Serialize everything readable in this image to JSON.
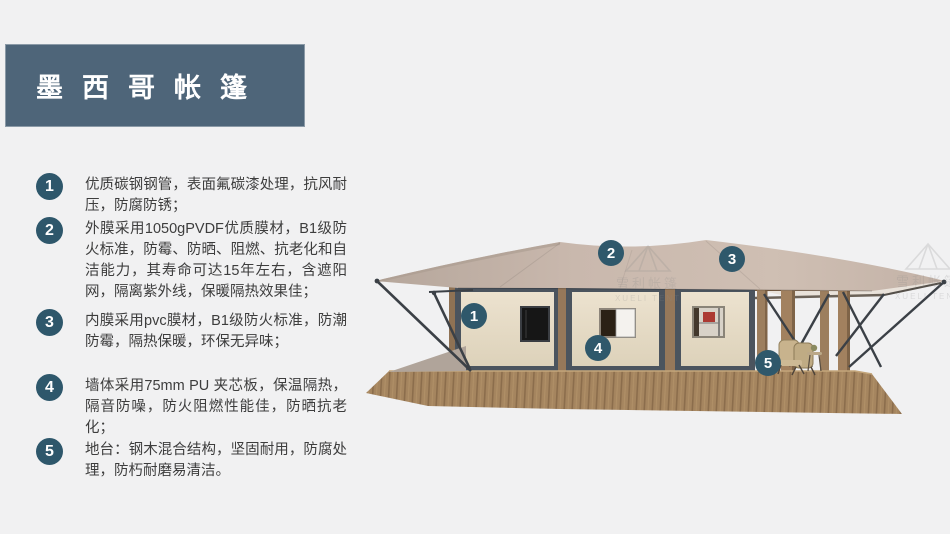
{
  "banner": {
    "title": "墨西哥帐篷"
  },
  "features": [
    {
      "num": "1",
      "text": "优质碳钢钢管，表面氟碳漆处理，抗风耐压，防腐防锈；"
    },
    {
      "num": "2",
      "text": "外膜采用1050gPVDF优质膜材，B1级防火标准，防霉、防晒、阻燃、抗老化和自洁能力，其寿命可达15年左右，含遮阳网，隔离紫外线，保暖隔热效果佳；"
    },
    {
      "num": "3",
      "text": "内膜采用pvc膜材，B1级防火标准，防潮防霉，隔热保暖，环保无异味；"
    },
    {
      "num": "4",
      "text": "墙体采用75mm PU 夹芯板，保温隔热，隔音防噪，防火阻燃性能佳，防晒抗老化；"
    },
    {
      "num": "5",
      "text": "地台：钢木混合结构，坚固耐用，防腐处理，防朽耐磨易清洁。"
    }
  ],
  "image": {
    "badges": [
      {
        "n": "1"
      },
      {
        "n": "2"
      },
      {
        "n": "3"
      },
      {
        "n": "4"
      },
      {
        "n": "5"
      }
    ],
    "watermark": {
      "cn": "雪利帐篷",
      "en": "XUELI TENT"
    }
  },
  "colors": {
    "banner_bg": "#4e6579",
    "badge_bg": "#2e576b",
    "background": "#f1f1f2",
    "canopy": "#c6b5aa",
    "wall": "#e7ddc9",
    "frame": "#4b545e",
    "deck": "#a5855f",
    "accent_red": "#ac3a33"
  }
}
